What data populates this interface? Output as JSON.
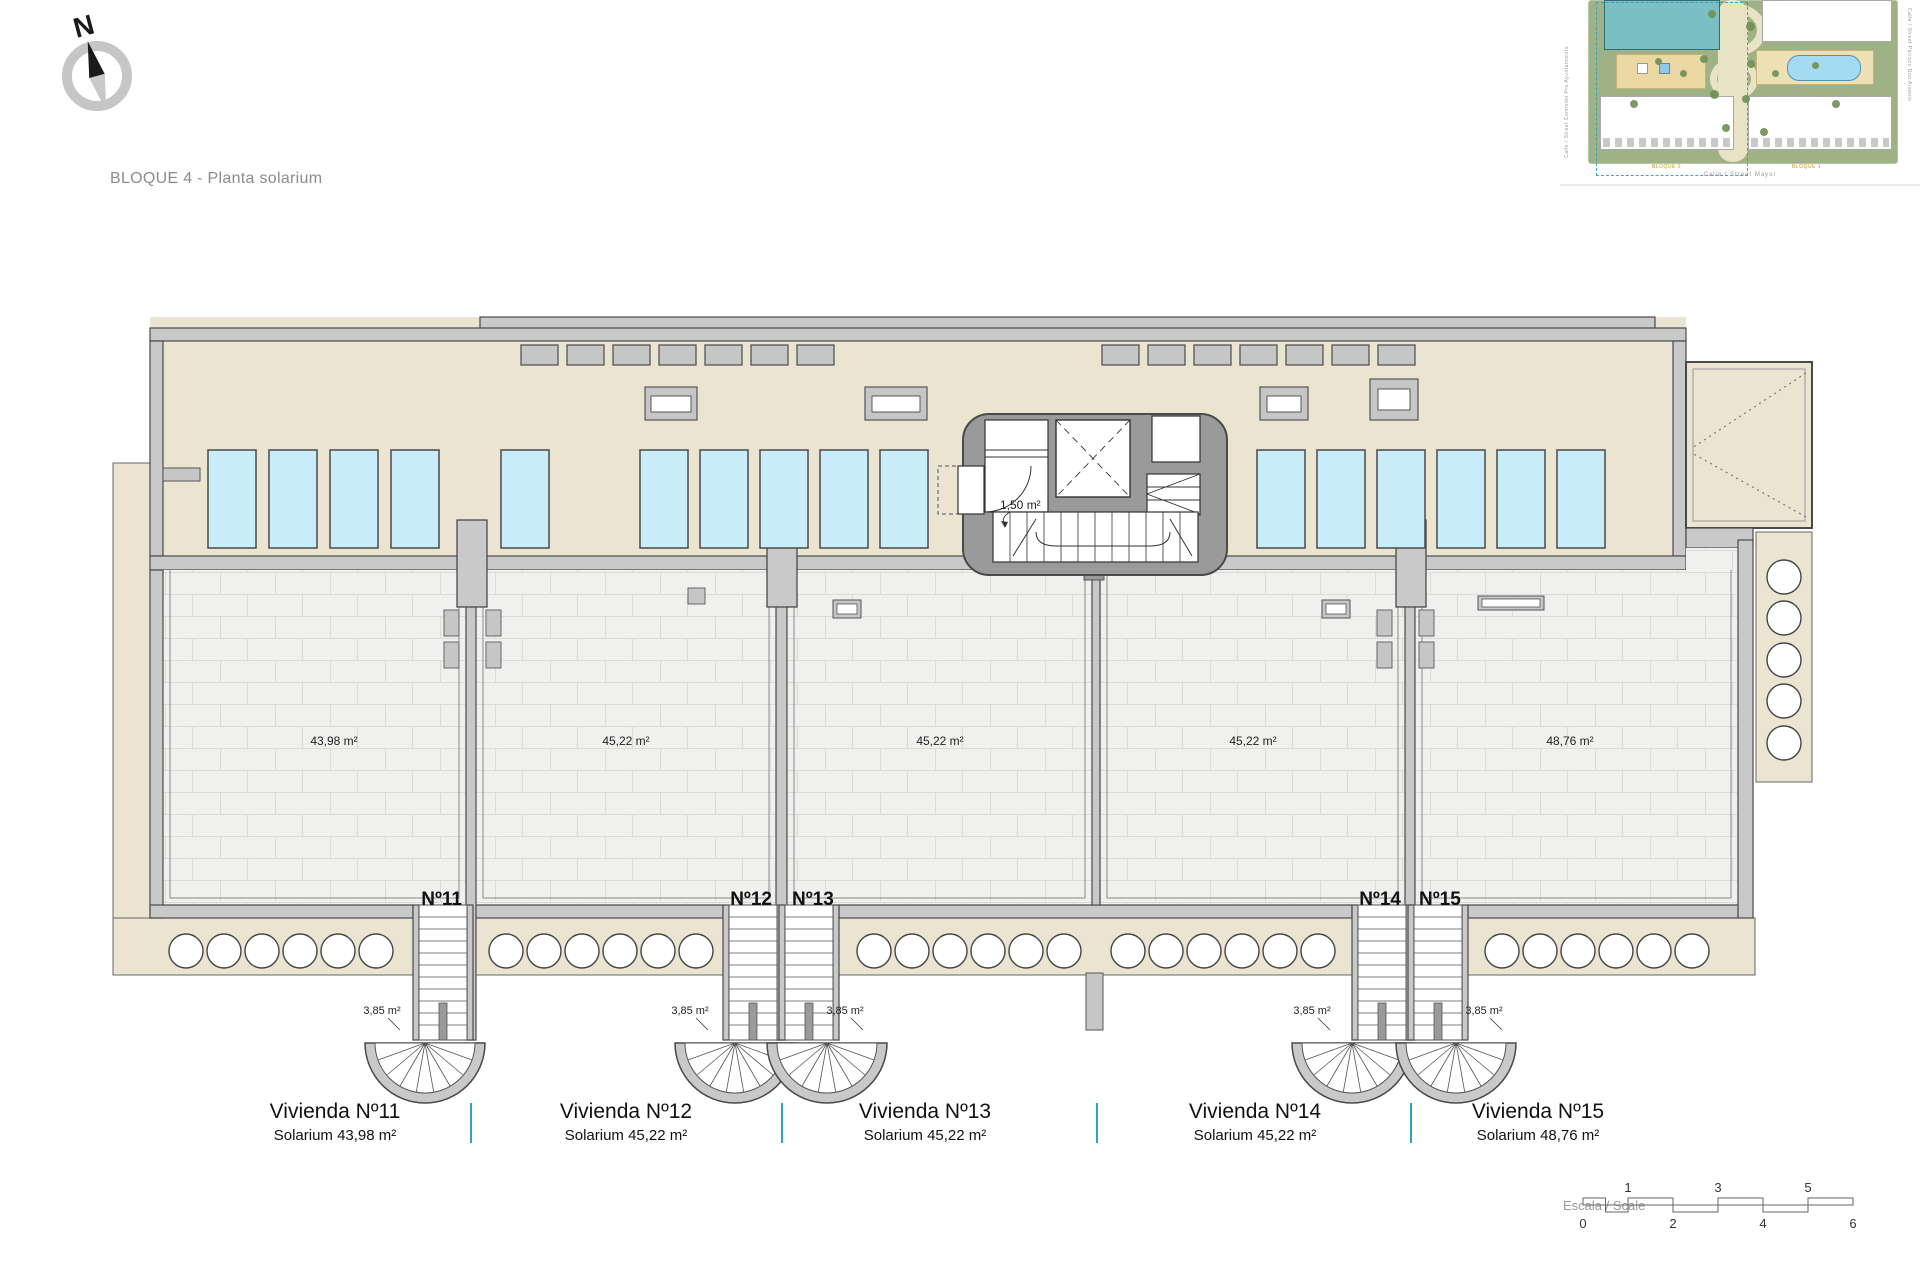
{
  "page": {
    "title": "BLOQUE 4 - Planta solarium"
  },
  "compass": {
    "label": "N"
  },
  "sitemap": {
    "streets": {
      "left": "Calle / Street Comisión Pro Ayuntamiento",
      "right": "Calle / Street Párroco Don Arsenio",
      "bottom": "Calle / Street Mayor"
    },
    "blocks": {
      "left": "BLOQUE 2",
      "right": "BLOQUE 1"
    }
  },
  "plan": {
    "core_room_area": "1,50 m²",
    "units": [
      {
        "label": "Nº11",
        "area": "43,98 m²",
        "stair_area": "3,85 m²",
        "caption_title": "Vivienda Nº11",
        "caption_sub": "Solarium 43,98 m²"
      },
      {
        "label": "Nº12",
        "area": "45,22 m²",
        "stair_area": "3,85 m²",
        "caption_title": "Vivienda Nº12",
        "caption_sub": "Solarium 45,22 m²"
      },
      {
        "label": "Nº13",
        "area": "45,22 m²",
        "stair_area": "3,85 m²",
        "caption_title": "Vivienda Nº13",
        "caption_sub": "Solarium 45,22 m²"
      },
      {
        "label": "Nº14",
        "area": "45,22 m²",
        "stair_area": "3,85 m²",
        "caption_title": "Vivienda Nº14",
        "caption_sub": "Solarium 45,22 m²"
      },
      {
        "label": "Nº15",
        "area": "48,76 m²",
        "stair_area": "3,85 m²",
        "caption_title": "Vivienda Nº15",
        "caption_sub": "Solarium 48,76 m²"
      }
    ]
  },
  "scalebar": {
    "label": "Escala / Scale",
    "top_ticks": [
      "1",
      "3",
      "5"
    ],
    "bottom_ticks": [
      "0",
      "2",
      "4",
      "6"
    ]
  }
}
